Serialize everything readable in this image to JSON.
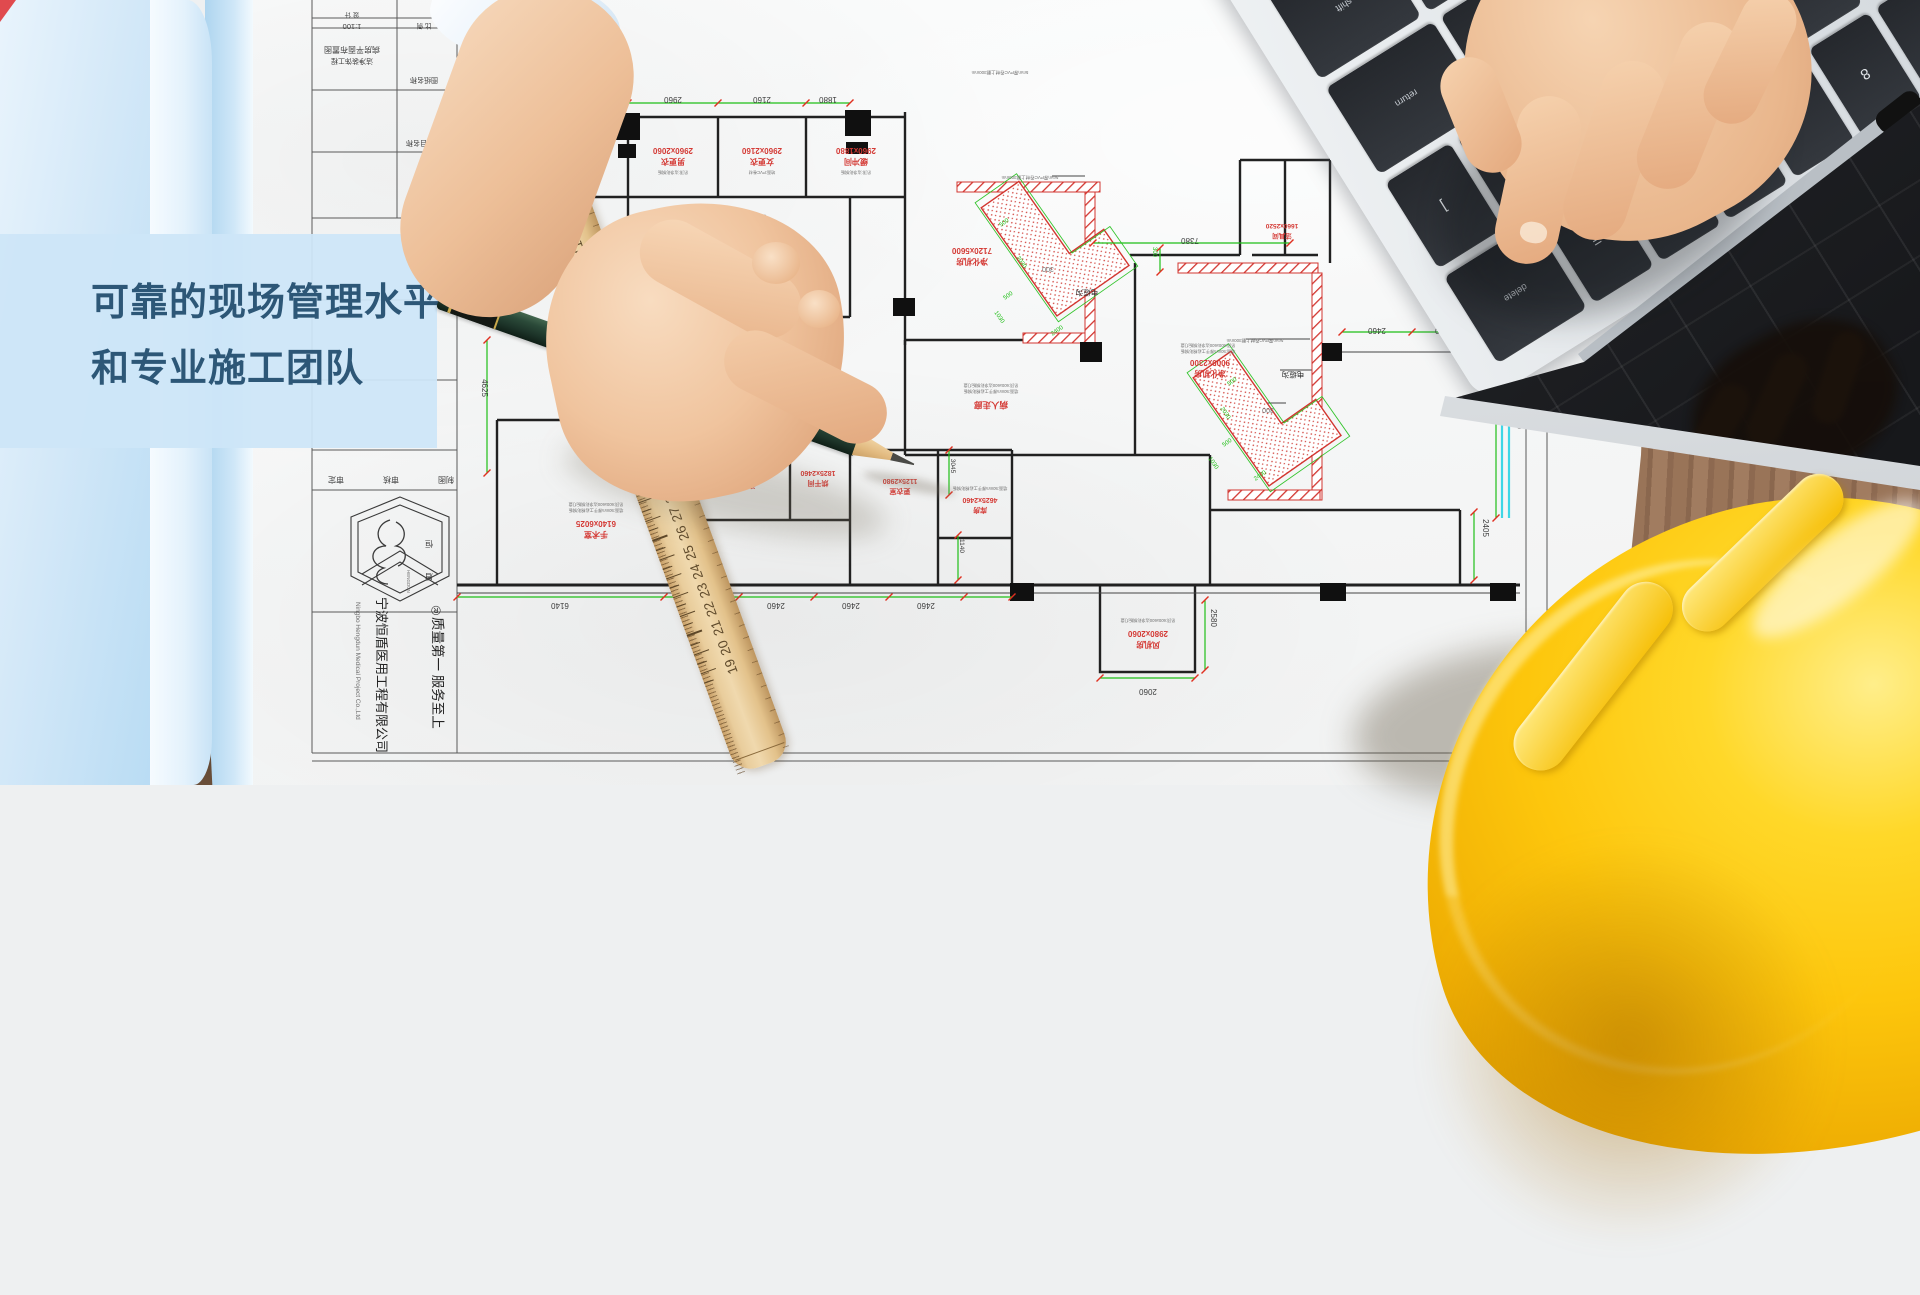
{
  "hero": {
    "line1": "可靠的现场管理水平",
    "line2": "和专业施工团队"
  },
  "pencil": {
    "print": "DRAWING PENCIL  No.7084  GauiArt",
    "grade": "2B"
  },
  "ruler": {
    "numbers": [
      48,
      47,
      46,
      45,
      44,
      43,
      42,
      41,
      40,
      39,
      38,
      37,
      36,
      35,
      34,
      33,
      32,
      31,
      30,
      29,
      28,
      27,
      26,
      25,
      24,
      23,
      22,
      21,
      20,
      19
    ]
  },
  "laptop": {
    "rows": [
      [
        "`",
        "1",
        "2",
        "3",
        "4",
        "5",
        "6",
        "7",
        "8",
        "9",
        "0",
        "-",
        "=",
        {
          "l": "delete",
          "w": 1.5
        }
      ],
      [
        {
          "l": "tab",
          "w": 1.5
        },
        "Q",
        "W",
        "E",
        "R",
        "T",
        "Y",
        "U",
        "I",
        "O",
        "P",
        "[",
        "]"
      ],
      [
        {
          "l": "caps",
          "w": 1.8
        },
        "A",
        "S",
        "D",
        "F",
        "G",
        "H",
        "J",
        "K",
        "L",
        ";",
        "'",
        {
          "l": "return",
          "w": 1.8
        }
      ],
      [
        {
          "l": "shift",
          "w": 2.3
        },
        "Z",
        "X",
        "C",
        "V",
        "B",
        "N",
        "M",
        ",",
        ".",
        "/",
        {
          "l": "shift",
          "w": 1.6
        }
      ],
      [
        {
          "l": "fn"
        },
        {
          "l": "control"
        },
        {
          "l": "option"
        },
        {
          "l": "command",
          "w": 1.3
        },
        {
          "l": "",
          "w": 5
        },
        {
          "l": "command",
          "w": 1.3
        },
        {
          "l": "option"
        },
        {
          "l": "enter",
          "w": 1.4
        }
      ]
    ]
  },
  "plan": {
    "texts": [
      {
        "t": "设 计",
        "x": 352,
        "y": 13,
        "s": 6.5
      },
      {
        "t": "比 例",
        "x": 424,
        "y": 24,
        "s": 6.5
      },
      {
        "t": "1:100",
        "x": 352,
        "y": 24,
        "s": 7.5
      },
      {
        "t": "病房平面布置图",
        "x": 352,
        "y": 47,
        "s": 8
      },
      {
        "t": "洁净装饰工程",
        "x": 352,
        "y": 59,
        "s": 7
      },
      {
        "t": "图纸名称",
        "x": 424,
        "y": 78,
        "s": 7
      },
      {
        "t": "项目名称",
        "x": 420,
        "y": 141,
        "s": 7
      },
      {
        "t": "审定",
        "x": 336,
        "y": 477,
        "s": 8
      },
      {
        "t": "审核",
        "x": 391,
        "y": 477,
        "s": 8
      },
      {
        "t": "制图",
        "x": 446,
        "y": 477,
        "s": 8
      },
      {
        "t": "恒",
        "x": 429,
        "y": 541,
        "s": 8
      },
      {
        "t": "盾",
        "x": 429,
        "y": 574,
        "s": 8
      },
      {
        "t": "HENGDUN",
        "x": 407,
        "y": 570,
        "s": 4.5,
        "r": 90,
        "a": "s",
        "c": "gray"
      },
      {
        "t": "®",
        "x": 436,
        "y": 606,
        "s": 13
      },
      {
        "t": "质量第一  服务至上",
        "x": 433,
        "y": 617,
        "s": 13.5,
        "r": 90,
        "a": "s",
        "c": "black"
      },
      {
        "t": "宁波恒盾医用工程有限公司",
        "x": 377,
        "y": 597,
        "s": 13,
        "r": 90,
        "a": "s",
        "c": "black"
      },
      {
        "t": "Ningbo Hengdun Medical Project Co.,Ltd",
        "x": 356,
        "y": 602,
        "s": 6.5,
        "r": 90,
        "a": "s",
        "c": "gray"
      },
      {
        "t": "2960",
        "x": 673,
        "y": 97
      },
      {
        "t": "2160",
        "x": 762,
        "y": 97
      },
      {
        "t": "1880",
        "x": 828,
        "y": 97
      },
      {
        "t": "7380",
        "x": 1190,
        "y": 238
      },
      {
        "t": "6140",
        "x": 560,
        "y": 603
      },
      {
        "t": "2460",
        "x": 701,
        "y": 603
      },
      {
        "t": "2460",
        "x": 776,
        "y": 603
      },
      {
        "t": "2460",
        "x": 851,
        "y": 603
      },
      {
        "t": "2460",
        "x": 926,
        "y": 603
      },
      {
        "t": "2060",
        "x": 1148,
        "y": 689
      },
      {
        "t": "2460",
        "x": 1377,
        "y": 328
      },
      {
        "t": "2400",
        "x": 1444,
        "y": 328
      },
      {
        "t": "300",
        "x": 1048,
        "y": 267,
        "c": "gray",
        "s": 7
      },
      {
        "t": "300",
        "x": 1268,
        "y": 408,
        "c": "gray",
        "s": 7
      },
      {
        "t": "4625",
        "x": 482,
        "y": 388,
        "r": 90
      },
      {
        "t": "5040",
        "x": 1517,
        "y": 420,
        "r": 90
      },
      {
        "t": "2405",
        "x": 1483,
        "y": 528,
        "r": 90
      },
      {
        "t": "2580",
        "x": 1211,
        "y": 618,
        "r": 90
      },
      {
        "t": "3045",
        "x": 951,
        "y": 466,
        "r": 90,
        "s": 6.5
      },
      {
        "t": "1140",
        "x": 960,
        "y": 546,
        "r": 90,
        "s": 6.5
      },
      {
        "t": "300",
        "x": 1153,
        "y": 252,
        "r": 90,
        "c": "green",
        "s": 6
      },
      {
        "t": "500",
        "x": 1005,
        "y": 224,
        "r": -35,
        "c": "green",
        "s": 6
      },
      {
        "t": "2030",
        "x": 1020,
        "y": 263,
        "r": 55,
        "c": "green",
        "s": 6
      },
      {
        "t": "500",
        "x": 1009,
        "y": 297,
        "r": -35,
        "c": "green",
        "s": 6
      },
      {
        "t": "1030",
        "x": 998,
        "y": 318,
        "r": 55,
        "c": "green",
        "s": 6
      },
      {
        "t": "2400",
        "x": 1058,
        "y": 332,
        "r": -35,
        "c": "green",
        "s": 6
      },
      {
        "t": "500",
        "x": 1233,
        "y": 383,
        "r": -35,
        "c": "green",
        "s": 6
      },
      {
        "t": "2030",
        "x": 1224,
        "y": 414,
        "r": 55,
        "c": "green",
        "s": 6
      },
      {
        "t": "500",
        "x": 1228,
        "y": 444,
        "r": -35,
        "c": "green",
        "s": 6
      },
      {
        "t": "1030",
        "x": 1212,
        "y": 464,
        "r": 55,
        "c": "green",
        "s": 6
      },
      {
        "t": "2400",
        "x": 1261,
        "y": 477,
        "r": -35,
        "c": "green",
        "s": 6
      },
      {
        "t": "2060x2160",
        "x": 570,
        "y": 146,
        "c": "red"
      },
      {
        "t": "库房",
        "x": 570,
        "y": 157,
        "c": "red"
      },
      {
        "t": "2960x2060",
        "x": 673,
        "y": 148,
        "c": "red"
      },
      {
        "t": "男更衣",
        "x": 673,
        "y": 159,
        "c": "red"
      },
      {
        "t": "2960x2160",
        "x": 762,
        "y": 148,
        "c": "red"
      },
      {
        "t": "女更衣",
        "x": 762,
        "y": 159,
        "c": "red"
      },
      {
        "t": "2960x1880",
        "x": 856,
        "y": 148,
        "c": "red"
      },
      {
        "t": "缓冲间",
        "x": 856,
        "y": 159,
        "c": "red"
      },
      {
        "t": "分娩、待产、隔离",
        "x": 739,
        "y": 245,
        "c": "red",
        "s": 9.5
      },
      {
        "t": "操作台",
        "x": 702,
        "y": 304,
        "c": "red",
        "s": 7
      },
      {
        "t": "器械台",
        "x": 767,
        "y": 304,
        "c": "red",
        "s": 7
      },
      {
        "t": "7120x5600",
        "x": 972,
        "y": 248,
        "c": "red"
      },
      {
        "t": "净化机房",
        "x": 972,
        "y": 259,
        "c": "red"
      },
      {
        "t": "病人走廊",
        "x": 991,
        "y": 402,
        "c": "red",
        "s": 8.5
      },
      {
        "t": "9000x2300",
        "x": 1210,
        "y": 360,
        "c": "red"
      },
      {
        "t": "净化机房",
        "x": 1210,
        "y": 371,
        "c": "red"
      },
      {
        "t": "1660x2520",
        "x": 1282,
        "y": 224,
        "c": "red",
        "s": 6.5
      },
      {
        "t": "洁具间",
        "x": 1282,
        "y": 234,
        "c": "red",
        "s": 6.5
      },
      {
        "t": "6140x6025",
        "x": 596,
        "y": 521,
        "c": "red"
      },
      {
        "t": "手术室",
        "x": 596,
        "y": 532,
        "c": "red"
      },
      {
        "t": "2190x2160",
        "x": 745,
        "y": 473,
        "c": "red",
        "s": 7
      },
      {
        "t": "清洗间",
        "x": 745,
        "y": 483,
        "c": "red",
        "s": 7
      },
      {
        "t": "1825x2460",
        "x": 818,
        "y": 471,
        "c": "red",
        "s": 7
      },
      {
        "t": "烘干间",
        "x": 818,
        "y": 481,
        "c": "red",
        "s": 7
      },
      {
        "t": "1125x2980",
        "x": 900,
        "y": 479,
        "c": "red",
        "s": 7
      },
      {
        "t": "更衣室",
        "x": 900,
        "y": 489,
        "c": "red",
        "s": 7
      },
      {
        "t": "4625x2460",
        "x": 980,
        "y": 498,
        "c": "red",
        "s": 7
      },
      {
        "t": "库房",
        "x": 980,
        "y": 508,
        "c": "red",
        "s": 7
      },
      {
        "t": "2980x2060",
        "x": 1148,
        "y": 631,
        "c": "red"
      },
      {
        "t": "风机房",
        "x": 1148,
        "y": 642,
        "c": "red"
      },
      {
        "t": "电缆沟",
        "x": 1087,
        "y": 290,
        "c": "black",
        "s": 7.5
      },
      {
        "t": "电缆沟",
        "x": 1293,
        "y": 372,
        "c": "black",
        "s": 7.5
      },
      {
        "t": "吊顶:600x600洁净彩钢板灯盘",
        "x": 739,
        "y": 215,
        "c": "gray",
        "s": 4.2
      },
      {
        "t": "墙面:50mm厚手工岩棉彩钢板",
        "x": 739,
        "y": 221,
        "c": "gray",
        "s": 4.2
      },
      {
        "t": "吊顶:600x600洁净彩钢板灯盘",
        "x": 991,
        "y": 384,
        "c": "gray",
        "s": 4.2
      },
      {
        "t": "墙面:50mm厚手工岩棉彩钢板",
        "x": 991,
        "y": 390,
        "c": "gray",
        "s": 4.2
      },
      {
        "t": "吊顶:600x600洁净彩钢板灯盘",
        "x": 1208,
        "y": 344,
        "c": "gray",
        "s": 4.2
      },
      {
        "t": "墙面:50mm厚手工岩棉彩钢板",
        "x": 1208,
        "y": 350,
        "c": "gray",
        "s": 4.2
      },
      {
        "t": "吊顶:600x600洁净彩钢板灯盘",
        "x": 596,
        "y": 503,
        "c": "gray",
        "s": 4.2
      },
      {
        "t": "墙面:50mm厚手工岩棉彩钢板",
        "x": 596,
        "y": 509,
        "c": "gray",
        "s": 4.2
      },
      {
        "t": "墙面:50mm厚手工岩棉彩钢板",
        "x": 980,
        "y": 487,
        "c": "gray",
        "s": 4.2
      },
      {
        "t": "吊顶:600x600洁净彩钢板灯盘",
        "x": 1148,
        "y": 619,
        "c": "gray",
        "s": 4.2
      },
      {
        "t": "吊顶:洁净彩钢板",
        "x": 673,
        "y": 171,
        "c": "gray",
        "s": 4.2
      },
      {
        "t": "地面:PVC卷材",
        "x": 762,
        "y": 171,
        "c": "gray",
        "s": 4.2
      },
      {
        "t": "吊顶:洁净彩钢板",
        "x": 856,
        "y": 171,
        "c": "gray",
        "s": 4.2
      },
      {
        "t": "5mm厚PVC卷材上翻300mm",
        "x": 1030,
        "y": 176,
        "c": "gray",
        "s": 4.5
      },
      {
        "t": "5mm厚PVC卷材上翻300mm",
        "x": 1255,
        "y": 339,
        "c": "gray",
        "s": 4.5
      },
      {
        "t": "5mm厚PVC卷材上翻300mm",
        "x": 1000,
        "y": 71,
        "c": "gray",
        "s": 4.5
      }
    ],
    "dimlines": [
      {
        "x1": 628,
        "y1": 103,
        "x2": 850,
        "y2": 103,
        "ticks": [
          628,
          718,
          806,
          850
        ]
      },
      {
        "x1": 1093,
        "y1": 243,
        "x2": 1290,
        "y2": 243,
        "ticks": [
          1093,
          1290
        ]
      },
      {
        "x1": 457,
        "y1": 597,
        "x2": 1012,
        "y2": 597,
        "ticks": [
          457,
          664,
          739,
          814,
          889,
          964,
          1012
        ]
      },
      {
        "x1": 1342,
        "y1": 332,
        "x2": 1475,
        "y2": 332,
        "ticks": [
          1342,
          1412,
          1475
        ]
      },
      {
        "x1": 1100,
        "y1": 678,
        "x2": 1195,
        "y2": 678,
        "ticks": [
          1100,
          1195
        ]
      },
      {
        "x1": 487,
        "y1": 340,
        "x2": 487,
        "y2": 473,
        "ticks": [
          340,
          473
        ]
      },
      {
        "x1": 1496,
        "y1": 380,
        "x2": 1496,
        "y2": 518,
        "ticks": [
          380,
          518
        ]
      },
      {
        "x1": 1474,
        "y1": 512,
        "x2": 1474,
        "y2": 580,
        "ticks": [
          512,
          580
        ]
      },
      {
        "x1": 1205,
        "y1": 600,
        "x2": 1205,
        "y2": 670,
        "ticks": [
          600,
          670
        ]
      },
      {
        "x1": 949,
        "y1": 450,
        "x2": 949,
        "y2": 495,
        "ticks": [
          450,
          495
        ]
      },
      {
        "x1": 958,
        "y1": 535,
        "x2": 958,
        "y2": 580,
        "ticks": [
          535,
          580
        ]
      },
      {
        "x1": 1160,
        "y1": 248,
        "x2": 1160,
        "y2": 272,
        "ticks": [
          248,
          272
        ]
      }
    ]
  },
  "colors": {
    "overlay_bg": "#cde6f8",
    "heading": "#2d5777",
    "dim_green": "#1fbf17",
    "annotation_red": "#d43a35",
    "wall_black": "#212121",
    "cyan_strip": "#3fd6e6",
    "hat_yellow": "#fdc60c",
    "pencil_green": "#2b4a39",
    "ruler_wood": "#e9cd9c",
    "desk_wood": "#997458",
    "key_dark": "#2a2d32"
  }
}
